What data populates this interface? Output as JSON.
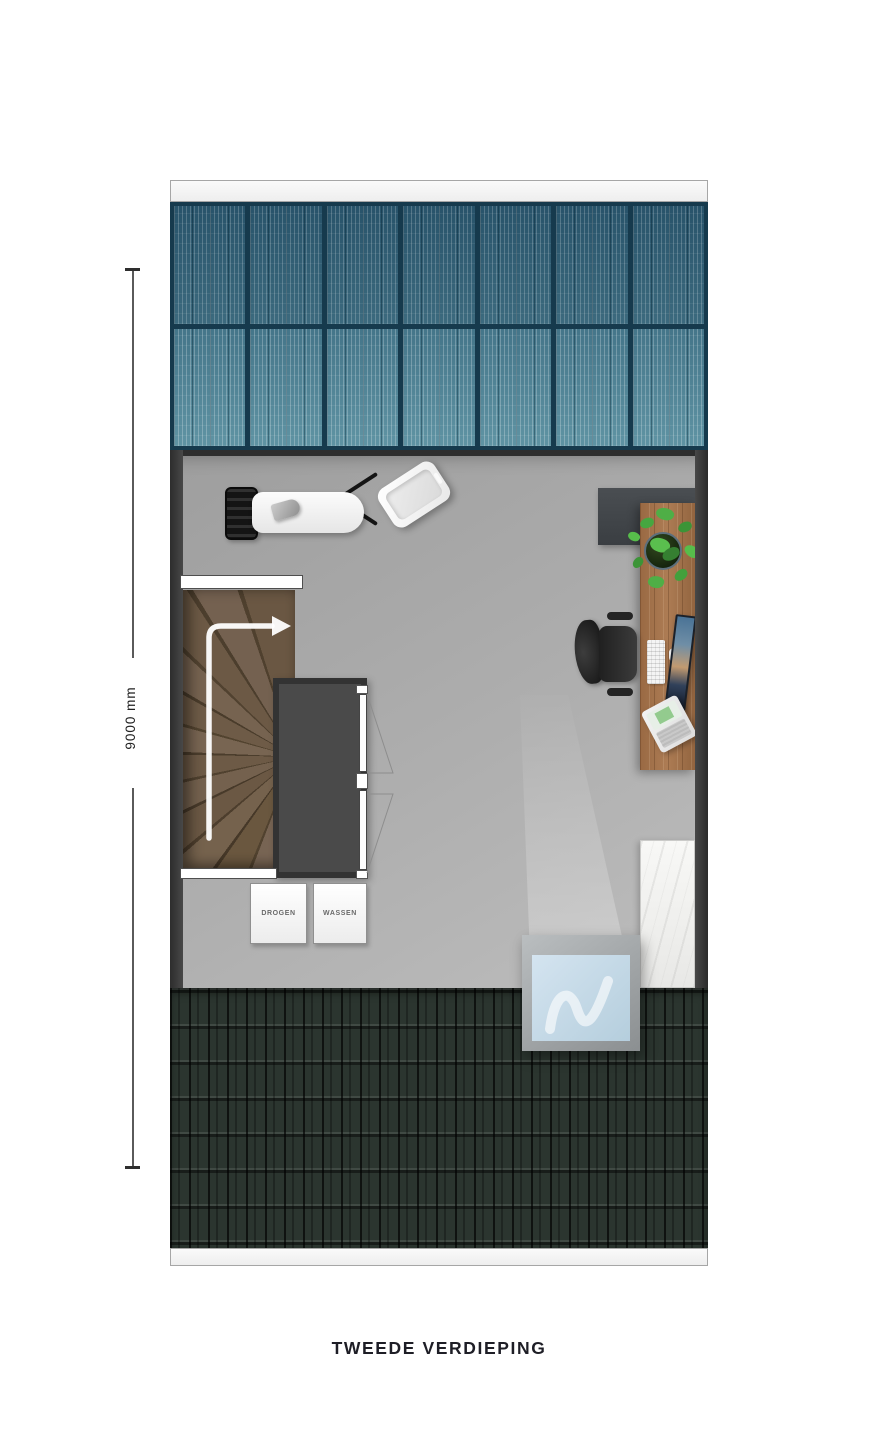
{
  "plan": {
    "title": "TWEEDE VERDIEPING",
    "dimension_label": "9000 mm",
    "appliances": [
      {
        "label": "DROGEN"
      },
      {
        "label": "WASSEN"
      }
    ],
    "objects": [
      "solar-panel-array",
      "roof-edge",
      "roof-tiles",
      "skylight-window",
      "winder-stairs",
      "stairs-up-arrow",
      "wardrobe",
      "wardrobe-doors",
      "dryer",
      "washer",
      "laundry-basket-black",
      "ironing-board",
      "iron",
      "laundry-basket-white",
      "storage-cabinet-dark",
      "desk",
      "potted-plant",
      "office-chair",
      "monitor",
      "keyboard",
      "mouse",
      "laptop",
      "tall-cabinet-white"
    ],
    "colors": {
      "solar_panel_dark": "#2e5a6e",
      "solar_panel_light": "#4a7d90",
      "solar_grid": "#163a4d",
      "roof_tile": "#2b352f",
      "floor": "#aeaeae",
      "wall": "#3a3a3a",
      "stairs_wood": "#6b5947",
      "desk_wood": "#a06f4a",
      "skylight_glass": "#c6dcea",
      "plant_green": "#4fae46",
      "arrow": "#ffffff"
    }
  }
}
